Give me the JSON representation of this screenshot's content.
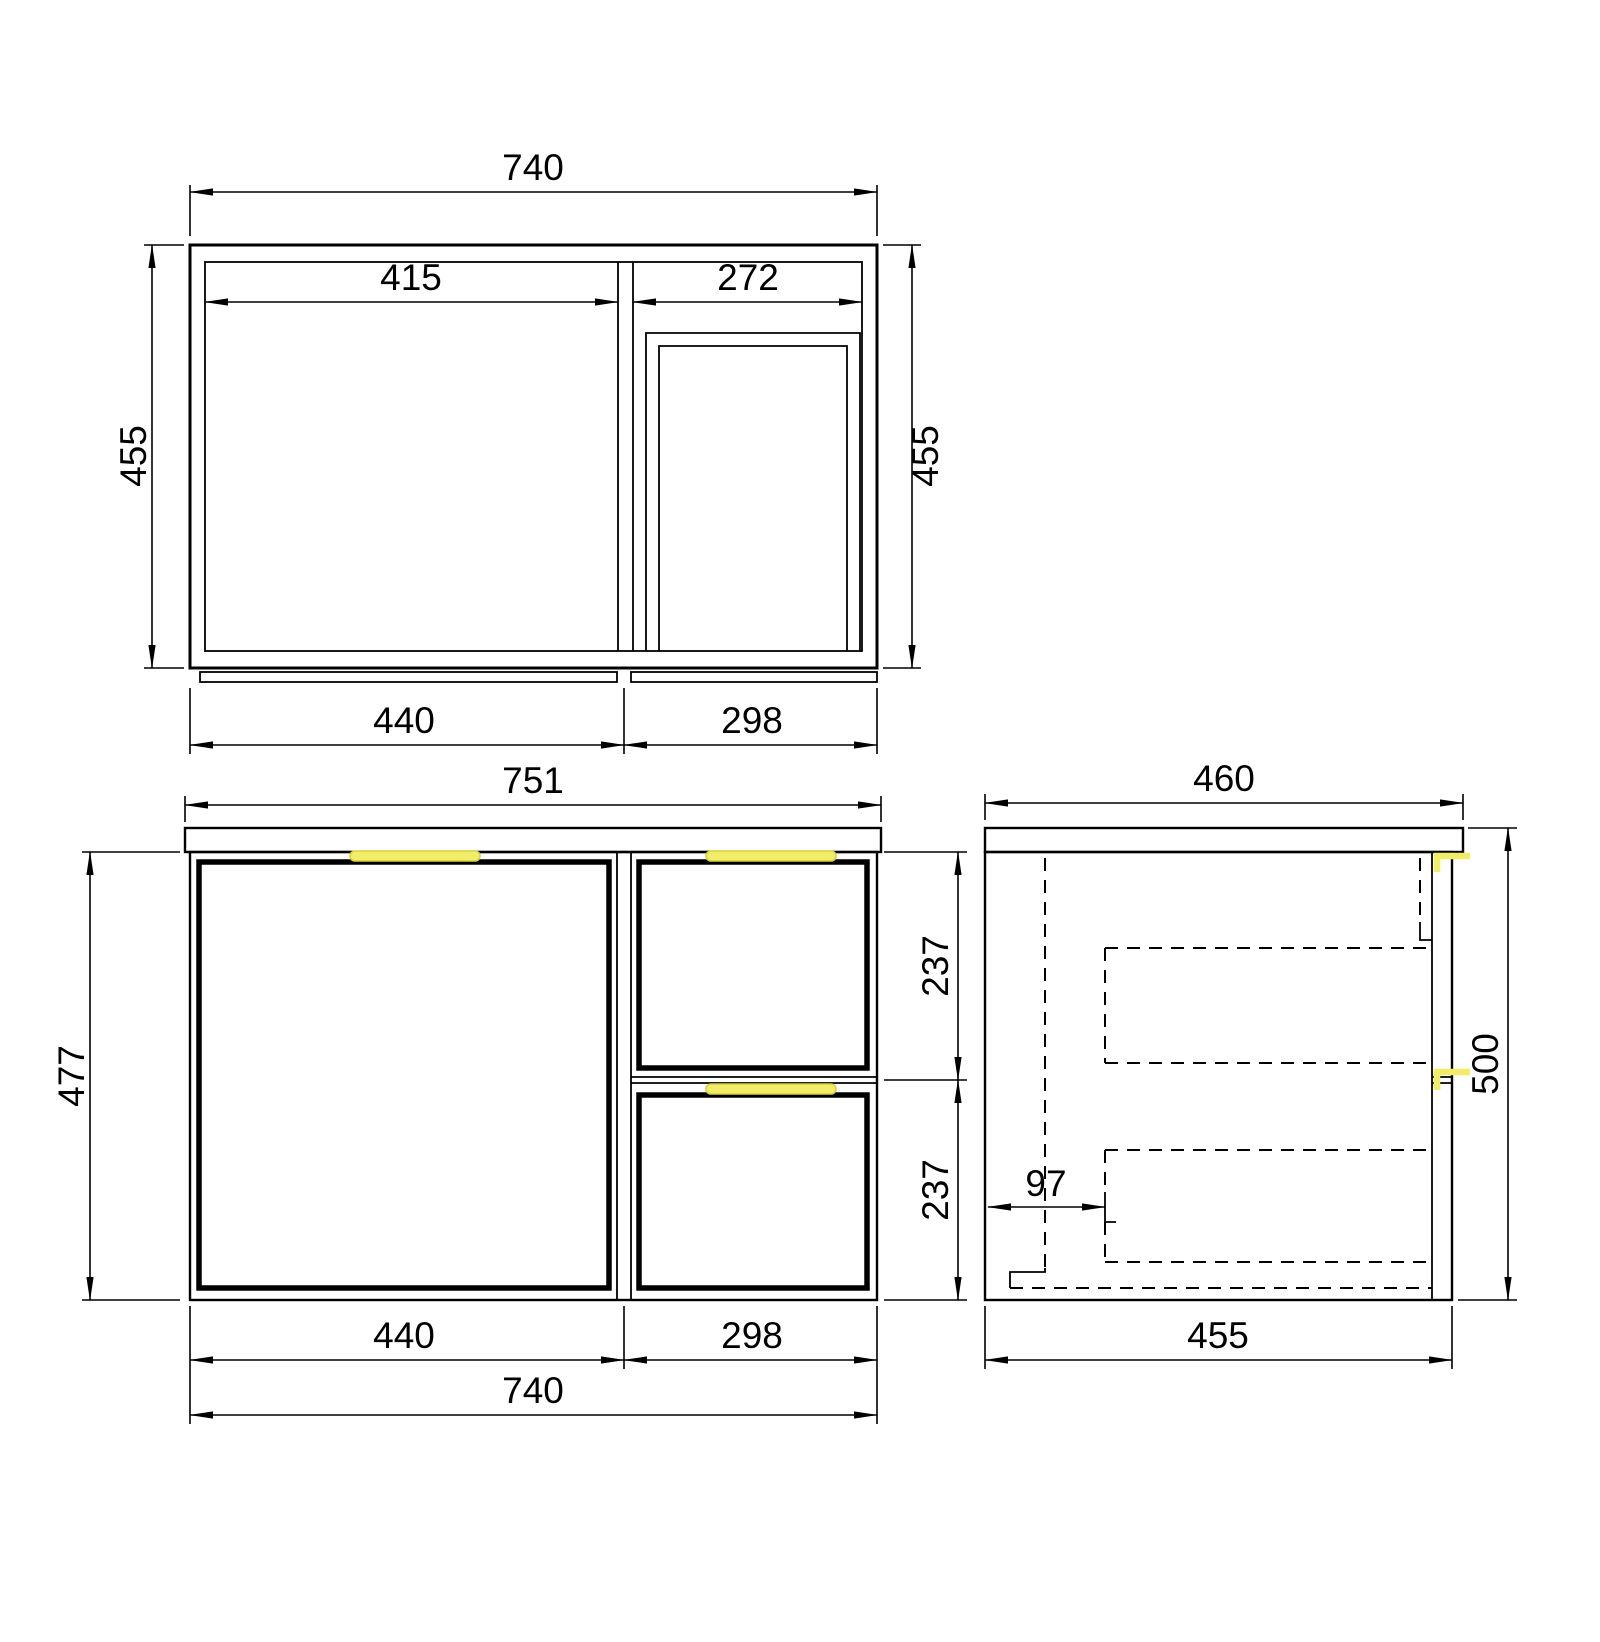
{
  "style": {
    "bg_color": "#ffffff",
    "line_color": "#000000",
    "handle_fill": "#f1ed68",
    "handle_edge": "#d8d13f"
  },
  "drawing": {
    "top_view": {
      "dims": {
        "overall_width": "740",
        "depth_left": "455",
        "depth_right": "455",
        "door_opening": "415",
        "drawer_opening": "272",
        "bottom_left_section": "440",
        "bottom_right_section": "298"
      }
    },
    "front_view": {
      "dims": {
        "countertop_width": "751",
        "cabinet_height": "477",
        "upper_drawer_height": "237",
        "lower_drawer_height": "237",
        "door_width": "440",
        "drawer_width": "298",
        "overall_width": "740"
      }
    },
    "side_view": {
      "dims": {
        "countertop_depth": "460",
        "overall_height": "500",
        "drawer_box_offset": "97",
        "cabinet_depth": "455"
      }
    }
  }
}
